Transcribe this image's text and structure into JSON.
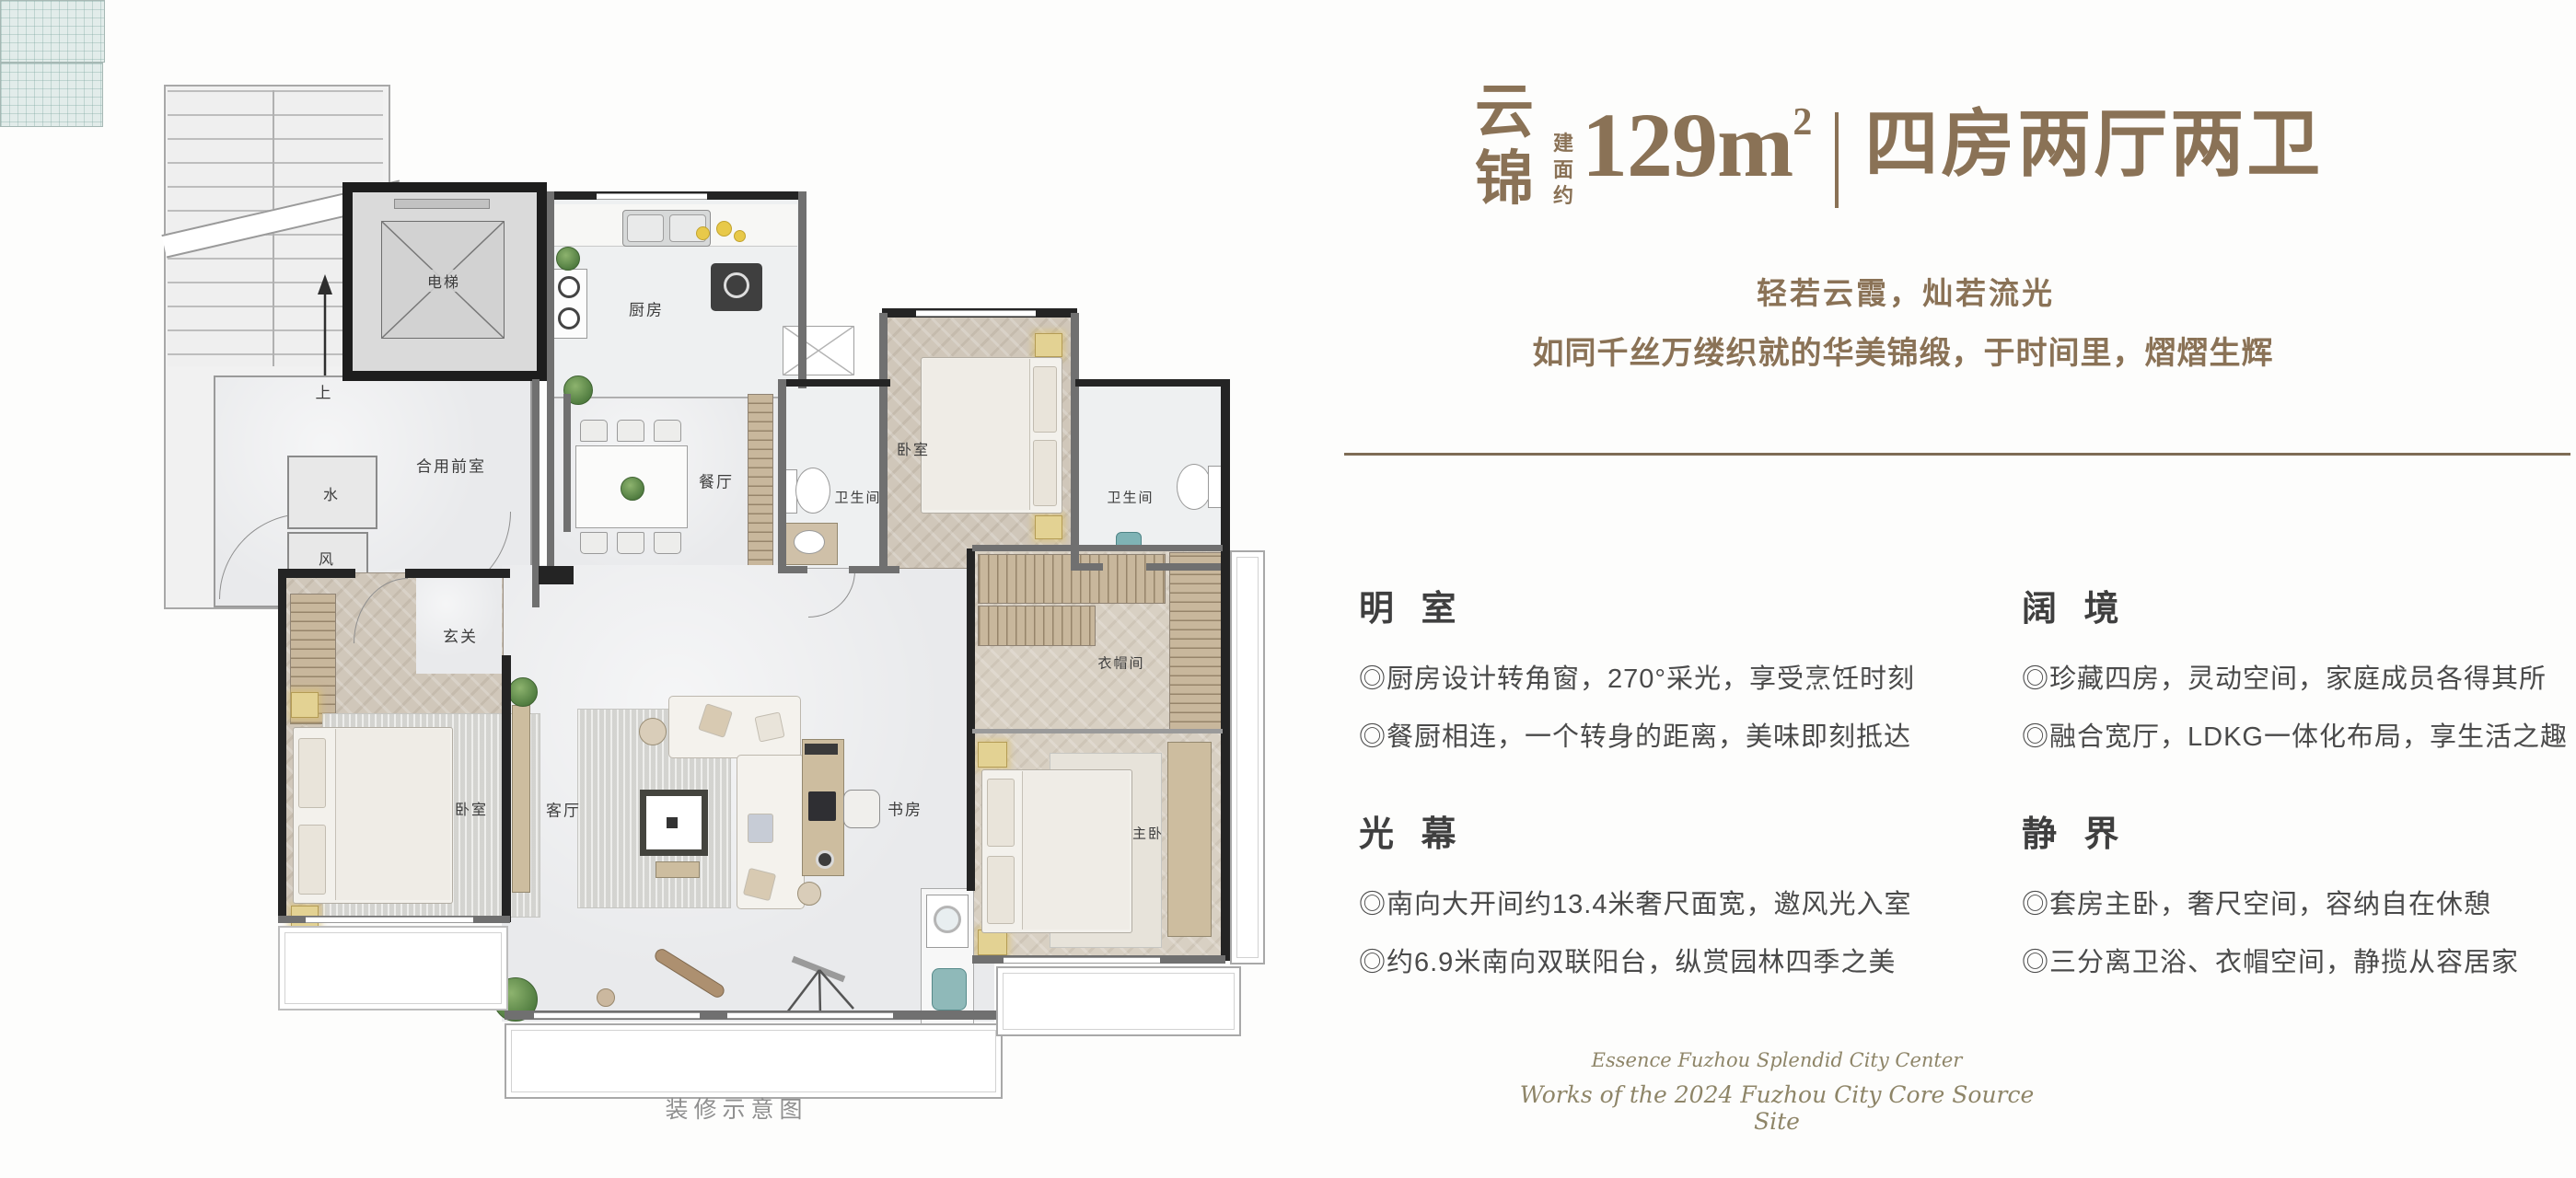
{
  "header": {
    "name": "云锦",
    "area_label": "建面约",
    "area_value": "129m",
    "area_sup": "2",
    "layout": "四房两厅两卫",
    "tagline1": "轻若云霞，灿若流光",
    "tagline2": "如同千丝万缕织就的华美锦缎，于时间里，熠熠生辉"
  },
  "features": [
    {
      "title": "明 室",
      "items": [
        "◎厨房设计转角窗，270°采光，享受烹饪时刻",
        "◎餐厨相连，一个转身的距离，美味即刻抵达"
      ]
    },
    {
      "title": "光 幕",
      "items": [
        "◎南向大开间约13.4米奢尺面宽，邀风光入室",
        "◎约6.9米南向双联阳台，纵赏园林四季之美"
      ]
    },
    {
      "title": "阔 境",
      "items": [
        "◎珍藏四房，灵动空间，家庭成员各得其所",
        "◎融合宽厅，LDKG一体化布局，享生活之趣"
      ]
    },
    {
      "title": "静 界",
      "items": [
        "◎套房主卧，奢尺空间，容纳自在休憩",
        "◎三分离卫浴、衣帽空间，静揽从容居家"
      ]
    }
  ],
  "footer": {
    "line1": "Essence Fuzhou  Splendid City Center",
    "line2": "Works of the 2024 Fuzhou City Core Source Site"
  },
  "plan": {
    "labels": {
      "elevator": "电梯",
      "up": "上",
      "water": "水",
      "wind": "风",
      "front_room": "合用前室",
      "kitchen": "厨房",
      "dining": "餐厅",
      "entry": "玄关",
      "bedroom_left": "卧室",
      "living": "客厅",
      "study": "书房",
      "bath_left": "卫生间",
      "bedroom_top": "卧室",
      "bath_right": "卫生间",
      "closet": "衣帽间",
      "master": "主卧",
      "caption": "装修示意图"
    }
  },
  "colors": {
    "accent_brown": "#8a7256",
    "divider_brown": "#7e6c55",
    "body_text": "#4a4a4a",
    "footer_olive": "#8e8568"
  }
}
